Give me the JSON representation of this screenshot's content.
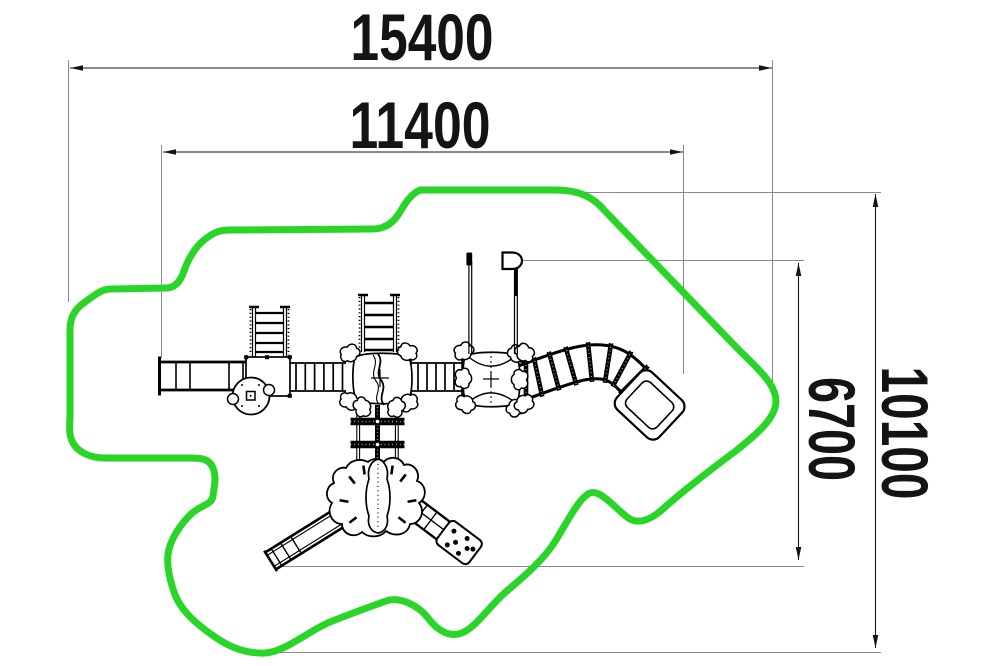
{
  "drawing": {
    "title": "playground-equipment-plan",
    "type": "plan-view technical drawing",
    "dimensions": {
      "overall_width": {
        "label": "15400"
      },
      "inner_width": {
        "label": "11400"
      },
      "inner_height": {
        "label": "6700"
      },
      "overall_height": {
        "label": "10100"
      }
    },
    "colors": {
      "safety_zone": "#2AD52A",
      "drawing_line": "#141414",
      "extension_line": "#8A8A8A",
      "dimension_text": "#141414"
    }
  }
}
